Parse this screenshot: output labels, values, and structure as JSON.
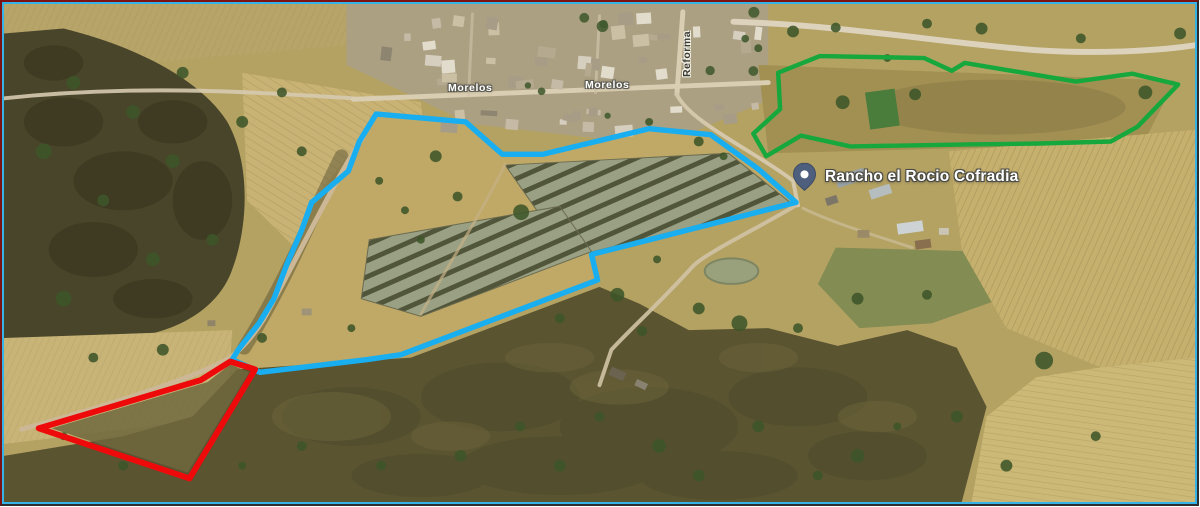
{
  "map": {
    "description": "Satellite view of Cofradia area with three surveyed parcel outlines",
    "place": {
      "name": "Rancho el Rocio Cofradia",
      "pin_icon": "map-pin-icon",
      "pin_color": "#4e5f7d"
    },
    "streets": {
      "morelos_1": "Morelos",
      "morelos_2": "Morelos",
      "reforma": "Reforma"
    }
  },
  "overlays": {
    "blue_parcel": {
      "color": "#18aef0",
      "width": 5.5,
      "points": "375,112 465,120 502,153 543,153 650,127 712,133 760,168 798,202 592,255 598,281 400,357 366,362 258,375 230,362 236,352 257,325 272,300 285,265 300,230 310,202 347,170 358,140"
    },
    "red_parcel": {
      "color": "#ee0a0a",
      "width": 6,
      "points": "228,364 198,383 35,432 187,483 253,372"
    },
    "green_parcel": {
      "color": "#16a73d",
      "width": 4.5,
      "points": "822,53 927,55 955,68 968,60 1080,79 1137,71 1183,82 1142,125 1115,140 1043,142 970,143 853,145 803,134 768,155 755,132 782,107 780,70"
    }
  },
  "frame": {
    "outer_top_left": "#7c1212",
    "outer_bottom_right": "#2e2e2e",
    "inner": "#35b2e8"
  }
}
